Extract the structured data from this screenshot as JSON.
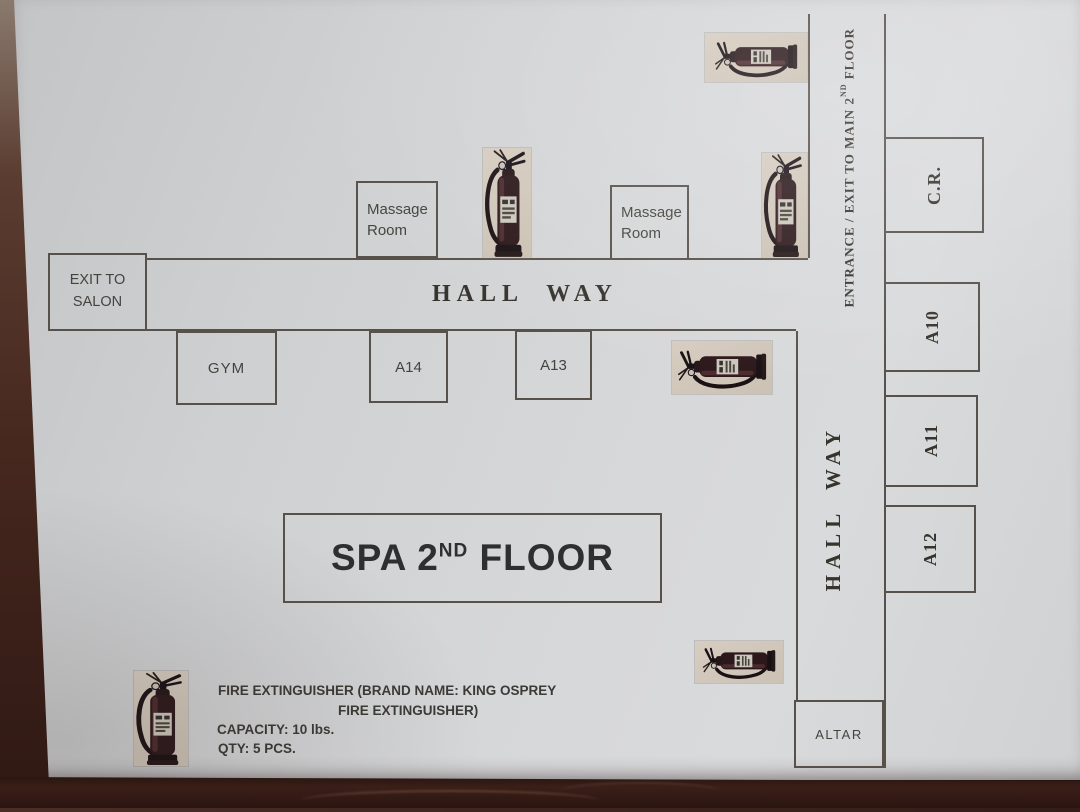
{
  "palette": {
    "wood_brown": "#3a211c",
    "paper_gray": "#d2d3d5",
    "plan_line": "#57514a",
    "extinguisher_bg_tan": "#cfc5b8",
    "extinguisher_body": "#2c181b"
  },
  "plan": {
    "labels": {
      "hallway_h": "HALL WAY",
      "hallway_v": "HALL WAY",
      "entrance_pre": "ENTRANCE / EXIT TO MAIN 2",
      "entrance_sup": "ND",
      "entrance_post": " FLOOR",
      "spa_pre": "SPA 2",
      "spa_sup": "ND",
      "spa_post": " FLOOR"
    },
    "rooms": {
      "exit_salon_l1": "EXIT TO",
      "exit_salon_l2": "SALON",
      "massage1_l1": "Massage",
      "massage1_l2": "Room",
      "massage2_l1": "Massage",
      "massage2_l2": "Room",
      "gym": "GYM",
      "a14": "A14",
      "a13": "A13",
      "cr": "C.R.",
      "a10": "A10",
      "a11": "A11",
      "a12": "A12",
      "altar": "ALTAR"
    },
    "legend": {
      "line1": "FIRE EXTINGUISHER (BRAND NAME: KING OSPREY",
      "line2": "FIRE EXTINGUISHER)",
      "capacity": "CAPACITY: 10 lbs.",
      "qty": "QTY: 5 PCS."
    },
    "extinguishers": {
      "icon": "fire-extinguisher-icon",
      "plan_marker_count": 5
    }
  }
}
